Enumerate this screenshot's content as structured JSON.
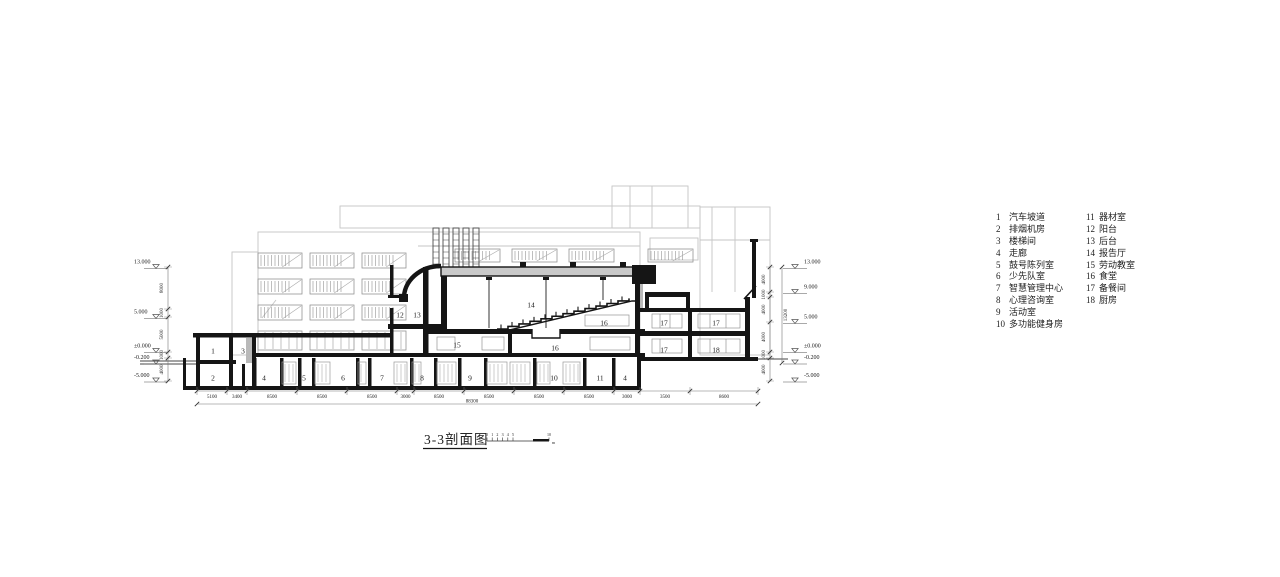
{
  "title": {
    "text": "3-3剖面图"
  },
  "scale_bar": {
    "ticks": [
      "0",
      "1",
      "2",
      "3",
      "4",
      "5",
      "10"
    ],
    "unit": "m"
  },
  "legend": {
    "col1": [
      {
        "num": "1",
        "name": "汽车坡道"
      },
      {
        "num": "2",
        "name": "排烟机房"
      },
      {
        "num": "3",
        "name": "楼梯间"
      },
      {
        "num": "4",
        "name": "走廊"
      },
      {
        "num": "5",
        "name": "鼓号陈列室"
      },
      {
        "num": "6",
        "name": "少先队室"
      },
      {
        "num": "7",
        "name": "智慧管理中心"
      },
      {
        "num": "8",
        "name": "心理咨询室"
      },
      {
        "num": "9",
        "name": "活动室"
      },
      {
        "num": "10",
        "name": "多功能健身房"
      }
    ],
    "col2": [
      {
        "num": "11",
        "name": "器材室"
      },
      {
        "num": "12",
        "name": "阳台"
      },
      {
        "num": "13",
        "name": "后台"
      },
      {
        "num": "14",
        "name": "报告厅"
      },
      {
        "num": "15",
        "name": "劳动教室"
      },
      {
        "num": "16",
        "name": "食堂"
      },
      {
        "num": "17",
        "name": "备餐间"
      },
      {
        "num": "18",
        "name": "厨房"
      }
    ]
  },
  "annotations": {
    "room_labels": [
      "1",
      "2",
      "3",
      "4",
      "5",
      "6",
      "7",
      "8",
      "9",
      "10",
      "11",
      "4",
      "12",
      "13",
      "14",
      "15",
      "16",
      "16",
      "17",
      "17",
      "17",
      "18"
    ]
  },
  "dimensions": {
    "bottom": [
      "5100",
      "3400",
      "8500",
      "8500",
      "8500",
      "3000",
      "8500",
      "8500",
      "8500",
      "8500",
      "3000",
      "3500",
      "8600"
    ],
    "bottom_overall": "88300",
    "left_vertical": [
      "8000",
      "1000",
      "5000",
      "1000",
      "4000"
    ],
    "right_vertical": [
      "4000",
      "1000",
      "4000",
      "4000",
      "1000",
      "4000"
    ],
    "right_overall": "13200"
  },
  "elevations": {
    "left": [
      "13.000",
      "5.000",
      "±0.000",
      "-0.200",
      "-5.000"
    ],
    "right": [
      "13.000",
      "9.000",
      "5.000",
      "±0.000",
      "-0.200",
      "-5.000"
    ]
  },
  "colors": {
    "ink": "#151515",
    "bg_line": "#c5c5c5",
    "win_line": "#949494",
    "dim": "#777777",
    "slab_fill": "#c9c9c9",
    "shaft_fill": "#b9b9b9"
  }
}
